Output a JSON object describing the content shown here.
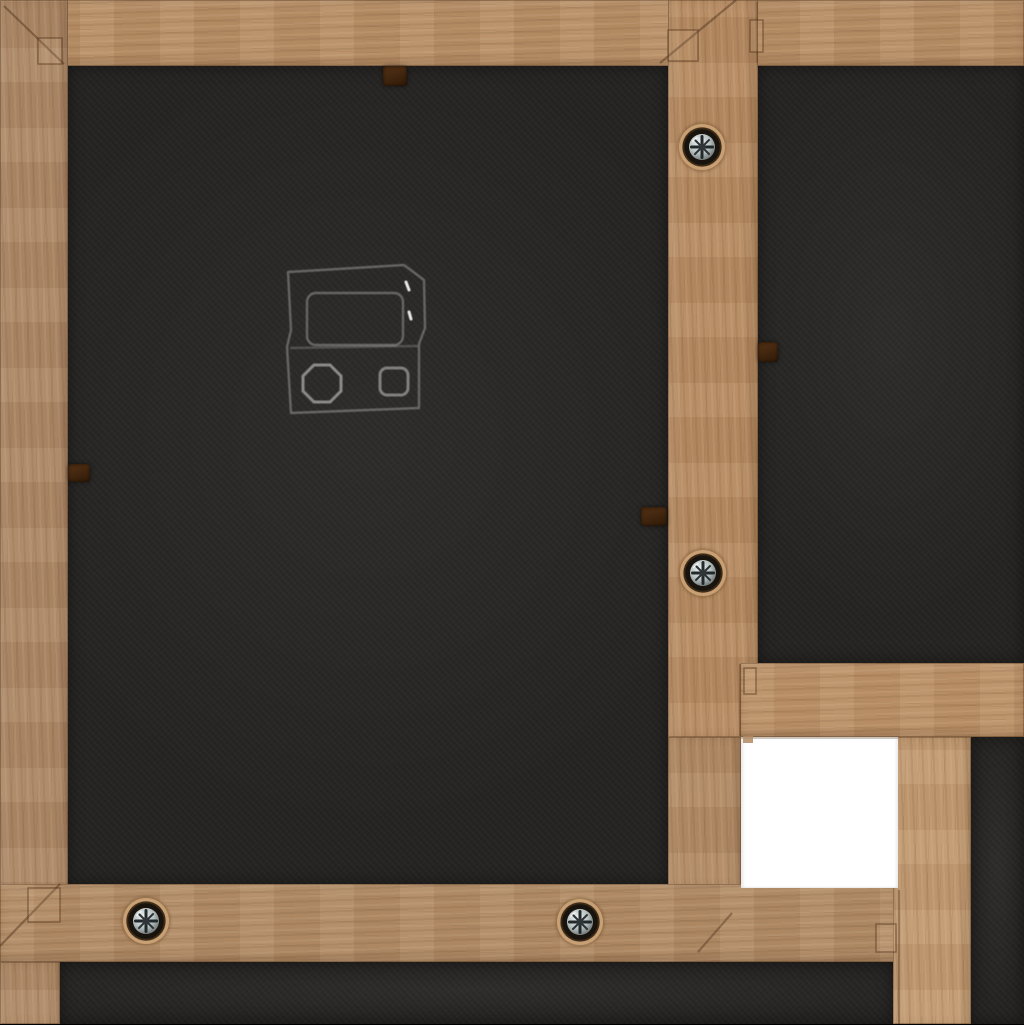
{
  "image": {
    "type": "photograph",
    "subject": "Back of a light-brown wooden collage picture frame",
    "description": "Rear view of a multi-aperture wooden photo frame showing tan wooden rails with visible grain and mitred corner joints, black backing boards, four silver Phillips screws set in dark countersunk holes, small dark glazier points holding the backings, a clear plastic hanging bracket on the large left backing, and one empty white square opening at the lower right."
  },
  "palette": {
    "wood": "#b18a63",
    "wood_light": "#c49c74",
    "wood_dark": "#8f6c4c",
    "backing_black": "#252422",
    "opening_white": "#ffffff",
    "screw_metal": "#c3cdcc",
    "screw_recess": "#19130d",
    "screw_halo": "#c9a073",
    "glazier_point_brown": "#40250f",
    "seam_brown": "#4a2e18"
  },
  "objects": {
    "rails": [
      {
        "name": "top-rail",
        "x": 0,
        "y": 0,
        "w": 1024,
        "h": 66,
        "grain": "h",
        "tone": "#b78e66"
      },
      {
        "name": "left-rail",
        "x": 0,
        "y": 0,
        "w": 68,
        "h": 962,
        "grain": "v",
        "tone": "#ab8766"
      },
      {
        "name": "center-vertical-rail",
        "x": 668,
        "y": 0,
        "w": 90,
        "h": 737,
        "grain": "v",
        "tone": "#b58a62"
      },
      {
        "name": "center-vertical-rail-lower",
        "x": 668,
        "y": 737,
        "w": 73,
        "h": 150,
        "grain": "v",
        "tone": "#b18a66"
      },
      {
        "name": "right-horizontal-rail",
        "x": 740,
        "y": 663,
        "w": 284,
        "h": 74,
        "grain": "h",
        "tone": "#bb9168"
      },
      {
        "name": "bottom-rail",
        "x": 0,
        "y": 884,
        "w": 899,
        "h": 78,
        "grain": "h",
        "tone": "#b18b66"
      },
      {
        "name": "bottom-left-vertical-rail",
        "x": 0,
        "y": 962,
        "w": 60,
        "h": 62,
        "grain": "v",
        "tone": "#ae8a68"
      },
      {
        "name": "right-vertical-rail",
        "x": 893,
        "y": 737,
        "w": 78,
        "h": 287,
        "grain": "v",
        "tone": "#c19a72"
      }
    ],
    "panels": [
      {
        "name": "left-backing-panel",
        "x": 68,
        "y": 66,
        "w": 600,
        "h": 818
      },
      {
        "name": "top-right-backing-panel",
        "x": 758,
        "y": 66,
        "w": 266,
        "h": 597
      },
      {
        "name": "bottom-backing-panel",
        "x": 60,
        "y": 962,
        "w": 833,
        "h": 62
      },
      {
        "name": "right-edge-backing-strip",
        "x": 971,
        "y": 737,
        "w": 53,
        "h": 287
      }
    ],
    "empty_opening": {
      "name": "empty-white-opening",
      "x": 741,
      "y": 737,
      "w": 157,
      "h": 151
    },
    "screws": [
      {
        "name": "screw-center-rail-top",
        "x": 702,
        "y": 147
      },
      {
        "name": "screw-center-rail-middle",
        "x": 703,
        "y": 573
      },
      {
        "name": "screw-bottom-rail-left",
        "x": 146,
        "y": 921
      },
      {
        "name": "screw-bottom-rail-right",
        "x": 580,
        "y": 922
      }
    ],
    "glazier_points": [
      {
        "name": "glazier-point-top",
        "x": 383,
        "y": 66,
        "w": 24,
        "h": 20
      },
      {
        "name": "glazier-point-left",
        "x": 68,
        "y": 464,
        "w": 22,
        "h": 18
      },
      {
        "name": "glazier-point-center-left",
        "x": 641,
        "y": 507,
        "w": 26,
        "h": 19
      },
      {
        "name": "glazier-point-center-right",
        "x": 758,
        "y": 342,
        "w": 20,
        "h": 20
      }
    ],
    "hanger_bracket": {
      "name": "plastic-hanger-bracket",
      "x": 278,
      "y": 260,
      "w": 152,
      "h": 160
    },
    "miter_seams": [
      {
        "x1": 4,
        "y1": 6,
        "x2": 64,
        "y2": 64,
        "o": 0.45
      },
      {
        "x1": 736,
        "y1": 0,
        "x2": 660,
        "y2": 63,
        "o": 0.45
      },
      {
        "x1": 0,
        "y1": 946,
        "x2": 60,
        "y2": 884,
        "o": 0.45
      },
      {
        "x1": 732,
        "y1": 913,
        "x2": 698,
        "y2": 952,
        "o": 0.4
      },
      {
        "x1": 740,
        "y1": 664,
        "x2": 740,
        "y2": 736,
        "o": 0.35
      },
      {
        "x1": 899,
        "y1": 890,
        "x2": 899,
        "y2": 1024,
        "o": 0.35
      },
      {
        "x1": 757,
        "y1": 2,
        "x2": 757,
        "y2": 63,
        "o": 0.22
      }
    ],
    "joint_marks": [
      {
        "x": 38,
        "y": 38,
        "w": 24,
        "h": 26
      },
      {
        "x": 668,
        "y": 30,
        "w": 30,
        "h": 31
      },
      {
        "x": 750,
        "y": 20,
        "w": 13,
        "h": 32
      },
      {
        "x": 28,
        "y": 888,
        "w": 32,
        "h": 34
      },
      {
        "x": 876,
        "y": 924,
        "w": 20,
        "h": 28
      },
      {
        "x": 744,
        "y": 668,
        "w": 12,
        "h": 26
      },
      {
        "x": 743,
        "y": 736,
        "w": 10,
        "h": 7,
        "solid": true
      }
    ]
  }
}
